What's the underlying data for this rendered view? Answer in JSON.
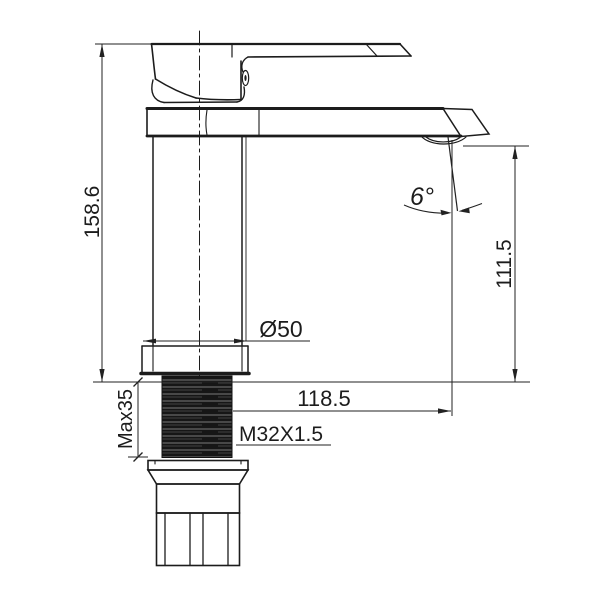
{
  "drawing": {
    "subject": "single-lever basin faucet side elevation technical drawing",
    "background": "#ffffff",
    "line_color": "#1c1c1c",
    "dimensions": {
      "overall_height": "158.6",
      "outlet_height": "111.5",
      "base_diameter": "Ø50",
      "spout_reach": "118.5",
      "thread_spec": "M32X1.5",
      "max_deck_thickness": "Max35",
      "outlet_angle": "6°"
    }
  }
}
